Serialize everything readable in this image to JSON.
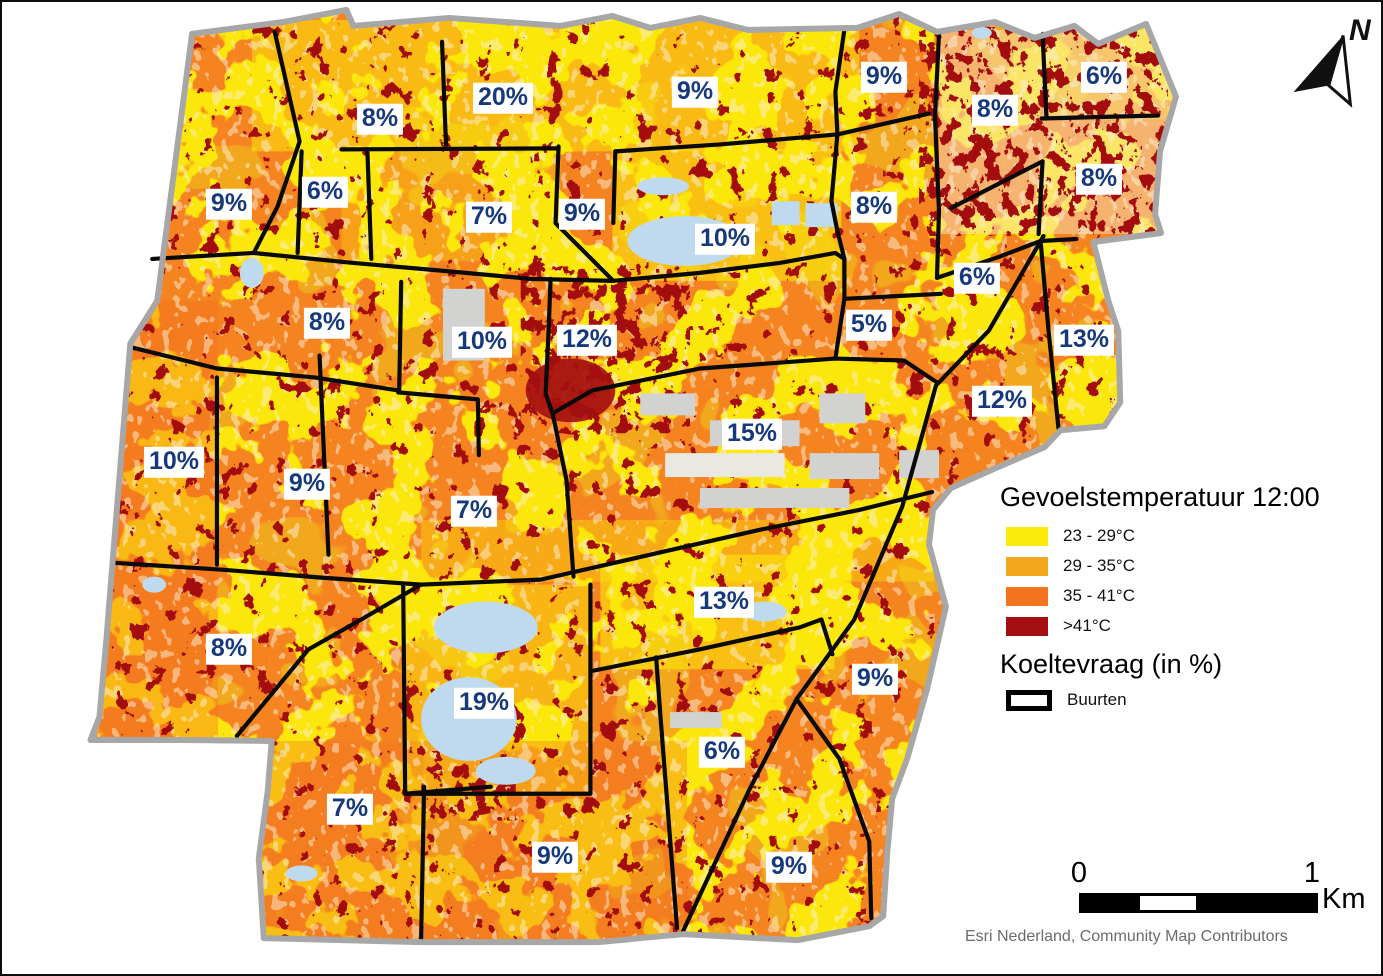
{
  "legend": {
    "temperature_title": "Gevoelstemperatuur 12:00",
    "classes": [
      {
        "label": "23 - 29°C",
        "color": "#FBEA0C"
      },
      {
        "label": "29 - 35°C",
        "color": "#F2A81D"
      },
      {
        "label": "35 - 41°C",
        "color": "#F4731F"
      },
      {
        "label": ">41°C",
        "color": "#A30E10"
      }
    ],
    "demand_title": "Koeltevraag (in %)",
    "boundary_label": "Buurten"
  },
  "north_arrow": "N",
  "scale_bar": {
    "start": "0",
    "end": "1",
    "unit": "Km"
  },
  "attribution": "Esri Nederland, Community Map Contributors",
  "map": {
    "colors": {
      "base_orange": "#F5831F",
      "yellow": "#FCE70A",
      "amber": "#F2A81D",
      "dark_red": "#A30E10",
      "water": "#BFD9EE",
      "buildings": "#D2D2D0",
      "city_outline": "#A7A7A7",
      "buurt_line": "#0A0A0A",
      "label_text": "#16397B"
    },
    "region_labels": [
      {
        "text": "8%",
        "x": 378,
        "y": 117
      },
      {
        "text": "20%",
        "x": 501,
        "y": 96
      },
      {
        "text": "9%",
        "x": 693,
        "y": 90
      },
      {
        "text": "9%",
        "x": 882,
        "y": 75
      },
      {
        "text": "6%",
        "x": 1102,
        "y": 75
      },
      {
        "text": "8%",
        "x": 993,
        "y": 108
      },
      {
        "text": "8%",
        "x": 1097,
        "y": 177
      },
      {
        "text": "6%",
        "x": 323,
        "y": 190
      },
      {
        "text": "9%",
        "x": 227,
        "y": 202
      },
      {
        "text": "7%",
        "x": 487,
        "y": 215
      },
      {
        "text": "9%",
        "x": 580,
        "y": 212
      },
      {
        "text": "10%",
        "x": 723,
        "y": 237
      },
      {
        "text": "8%",
        "x": 872,
        "y": 205
      },
      {
        "text": "6%",
        "x": 975,
        "y": 276
      },
      {
        "text": "8%",
        "x": 325,
        "y": 321
      },
      {
        "text": "10%",
        "x": 480,
        "y": 340
      },
      {
        "text": "12%",
        "x": 585,
        "y": 338
      },
      {
        "text": "5%",
        "x": 867,
        "y": 323
      },
      {
        "text": "13%",
        "x": 1082,
        "y": 338
      },
      {
        "text": "12%",
        "x": 1000,
        "y": 399
      },
      {
        "text": "10%",
        "x": 172,
        "y": 460
      },
      {
        "text": "9%",
        "x": 305,
        "y": 482
      },
      {
        "text": "15%",
        "x": 750,
        "y": 432
      },
      {
        "text": "7%",
        "x": 472,
        "y": 509
      },
      {
        "text": "13%",
        "x": 722,
        "y": 600
      },
      {
        "text": "8%",
        "x": 227,
        "y": 647
      },
      {
        "text": "19%",
        "x": 482,
        "y": 701
      },
      {
        "text": "9%",
        "x": 873,
        "y": 677
      },
      {
        "text": "6%",
        "x": 720,
        "y": 750
      },
      {
        "text": "7%",
        "x": 348,
        "y": 807
      },
      {
        "text": "9%",
        "x": 553,
        "y": 855
      },
      {
        "text": "9%",
        "x": 787,
        "y": 865
      }
    ]
  }
}
